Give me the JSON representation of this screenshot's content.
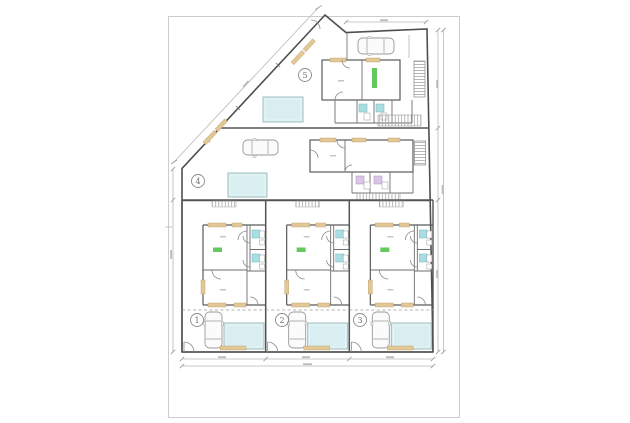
{
  "sheet": {
    "description": "Architectural site plan drawing with five dwelling units, pools and parked cars",
    "unit_badges": [
      {
        "label": "1"
      },
      {
        "label": "2"
      },
      {
        "label": "3"
      },
      {
        "label": "4"
      },
      {
        "label": "5"
      }
    ],
    "colors": {
      "wall": "#555555",
      "interior_wall": "#6e6e6e",
      "pool_fill": "#d9eef0",
      "pool_border": "#9fbfc2",
      "window_green": "#55c24e",
      "bath_fixture_cyan": "#aadde2",
      "bath_fixture_purple": "#d9c6e6",
      "timber_tan": "#e3c897",
      "dimension_line": "#b8b8b8",
      "sheet_border": "#cccccc"
    }
  }
}
